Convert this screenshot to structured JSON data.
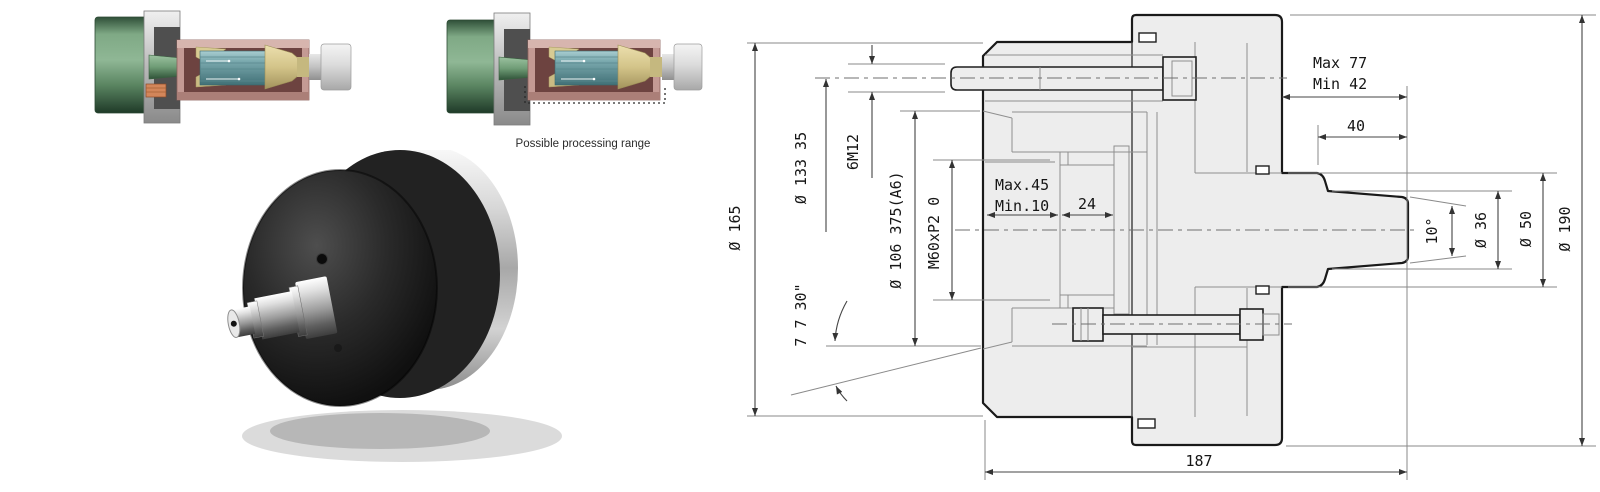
{
  "figure": {
    "caption": "Possible processing range"
  },
  "drawing": {
    "line_color": "#1a1a1a",
    "fill_color": "#ededed",
    "labels": {
      "dia165": "Ø 165",
      "dia133_35": "Ø 133 35",
      "bolt_count": "6M12",
      "dia106_375": "Ø 106 375(A6)",
      "thread": "M60xP2 0",
      "taper_angle": "7 7 30\"",
      "clamp_max": "Max.45",
      "clamp_min": "Min.10",
      "len24": "24",
      "stroke_max": "Max 77",
      "stroke_min": "Min 42",
      "len40": "40",
      "nose_angle": "10°",
      "dia36": "Ø 36",
      "dia50": "Ø 50",
      "dia190": "Ø 190",
      "total_len": "187"
    }
  }
}
